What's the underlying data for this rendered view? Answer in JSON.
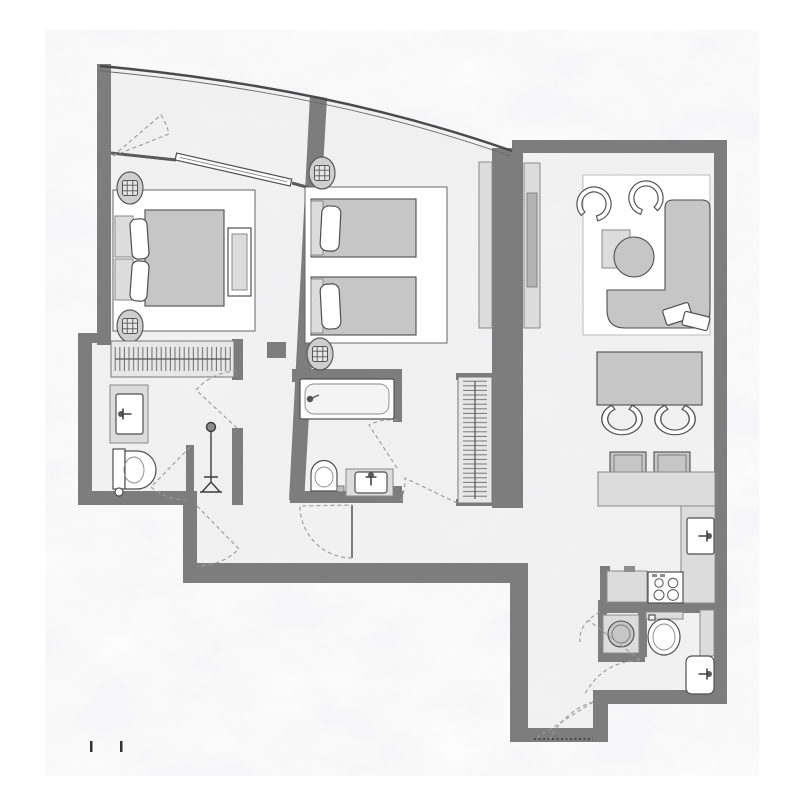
{
  "meta": {
    "title_text_visible": false,
    "visible_text": []
  },
  "colors": {
    "page_bg": "#ffffff",
    "wall": "#7d7d7d",
    "wall_edge": "#4a4a4a",
    "floor_base": "#f4f3f3",
    "floor_tint": "#d8d8dc",
    "furniture": "#c6c6c6",
    "furniture_light": "#dcdcdc",
    "fixture_white": "#ffffff",
    "line": "#4f4f4f",
    "line_soft": "#8a8a8a",
    "dashed": "#9a9a9a",
    "accent_dark": "#3c3c3c"
  },
  "plan": {
    "type": "residential-apartment-floor-plan",
    "facade": "curved-glazed-balcony-top",
    "rooms": [
      {
        "id": "balcony",
        "fixtures": [
          "door-swing-dashes"
        ]
      },
      {
        "id": "master-bedroom",
        "fixtures": [
          "double-bed",
          "pillow-left",
          "pillow-right",
          "nightstand-top",
          "nightstand-bottom",
          "bench",
          "wardrobe-hanging-rail",
          "sliding-glass-door",
          "column-top",
          "column-bottom"
        ]
      },
      {
        "id": "master-bathroom",
        "fixtures": [
          "vanity-sink",
          "toilet",
          "shower-head",
          "door-swing-dashes"
        ]
      },
      {
        "id": "twin-bedroom",
        "fixtures": [
          "single-bed-top",
          "single-bed-bottom",
          "pillow-top",
          "pillow-bottom",
          "wardrobe-panel",
          "column-top",
          "column-bottom"
        ]
      },
      {
        "id": "bathroom-two",
        "fixtures": [
          "bathtub",
          "toilet",
          "vanity-sink",
          "door-swing-dashes"
        ]
      },
      {
        "id": "hallway",
        "fixtures": [
          "closet-hanging-rail",
          "door-leaf",
          "door-swing-dashes"
        ]
      },
      {
        "id": "living-room",
        "fixtures": [
          "l-shaped-sofa",
          "sofa-cushion-1",
          "sofa-cushion-2",
          "coffee-table-round",
          "side-table",
          "armchair-left",
          "armchair-right",
          "tv-panel"
        ]
      },
      {
        "id": "dining-area",
        "fixtures": [
          "dining-table",
          "chair-left",
          "chair-right",
          "bar-stool-left",
          "bar-stool-right"
        ]
      },
      {
        "id": "kitchen",
        "fixtures": [
          "counter-l-shape",
          "sink",
          "cooktop-4-burners",
          "cabinet"
        ]
      },
      {
        "id": "utility-niche",
        "fixtures": [
          "washing-machine"
        ]
      },
      {
        "id": "guest-bathroom",
        "fixtures": [
          "toilet",
          "basin",
          "door-swing-dashes"
        ]
      },
      {
        "id": "entry",
        "fixtures": [
          "entry-door-swing-dashes",
          "threshold-dotted-line"
        ]
      }
    ],
    "column_count": 4,
    "scale_tick_marks": 2
  }
}
